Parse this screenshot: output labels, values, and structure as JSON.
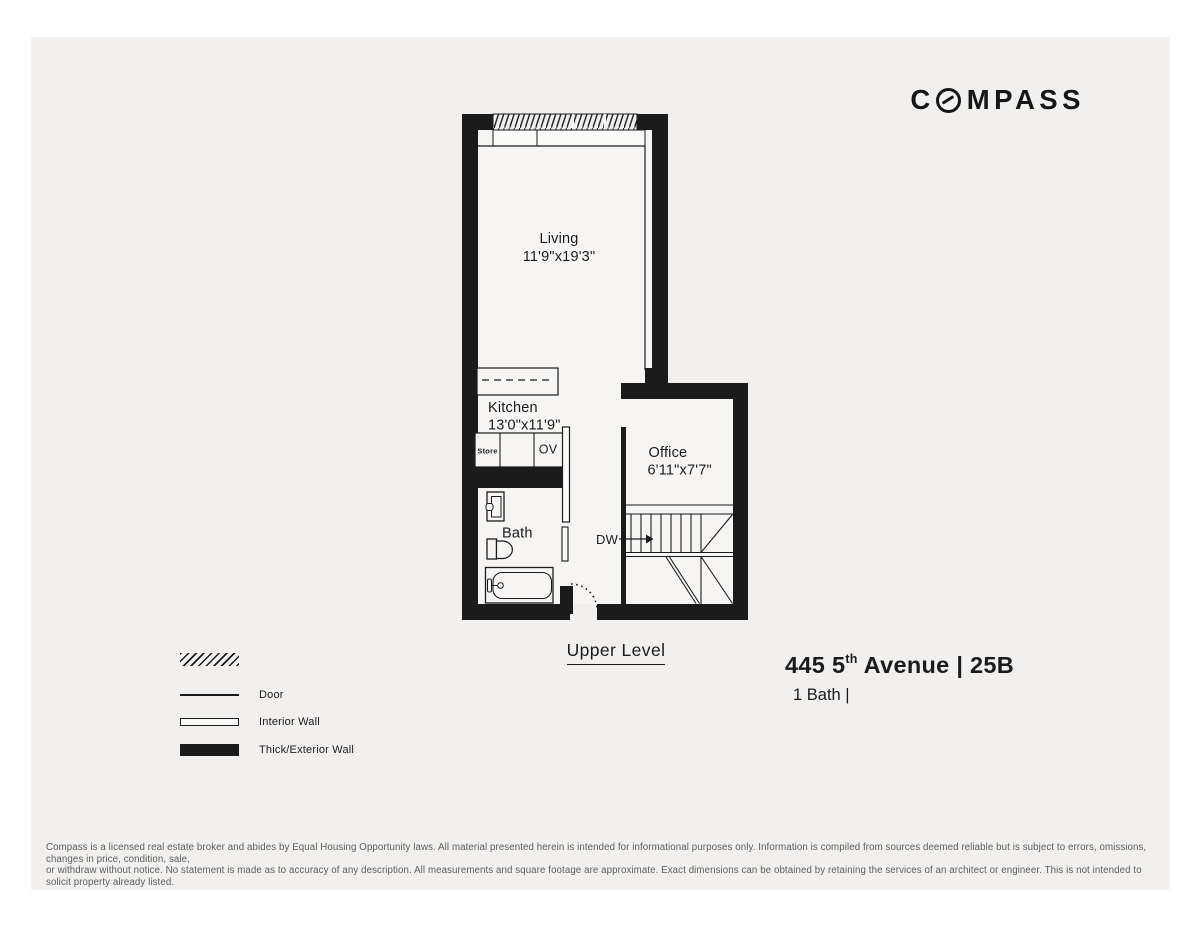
{
  "logo": {
    "prefix": "C",
    "suffix": "MPASS"
  },
  "plan": {
    "level_label": "Upper Level",
    "rooms": {
      "living": {
        "name": "Living",
        "dims": "11'9\"x19'3\""
      },
      "kitchen": {
        "name": "Kitchen",
        "dims": "13'0\"x11'9\""
      },
      "office": {
        "name": "Office",
        "dims": "6'11\"x7'7\""
      },
      "bath": {
        "name": "Bath"
      }
    },
    "fixtures": {
      "store": "Store",
      "oven": "OV",
      "dumbwaiter": "DW"
    }
  },
  "legend": {
    "items": [
      {
        "swatch": "window-hatch",
        "label": ""
      },
      {
        "swatch": "door-line",
        "label": "Door"
      },
      {
        "swatch": "interior-wall",
        "label": "Interior Wall"
      },
      {
        "swatch": "exterior-wall",
        "label": "Thick/Exterior Wall"
      }
    ]
  },
  "listing": {
    "address_prefix": "445 5",
    "address_sup": "th",
    "address_suffix": " Avenue | 25B",
    "baths": "1 Bath |"
  },
  "disclaimer": {
    "line1": "Compass is a licensed real estate broker and abides by Equal Housing Opportunity laws. All material presented herein is intended for informational purposes only. Information is compiled from sources deemed reliable but is subject to errors, omissions, changes in price, condition, sale,",
    "line2": "or withdraw without notice. No statement is made as to accuracy of any description. All measurements and square footage are approximate. Exact dimensions can be obtained by retaining the services of an architect or engineer. This is not intended to solicit property already listed."
  },
  "colors": {
    "wall": "#1b1b1b",
    "panel": "#f1f0ef"
  }
}
